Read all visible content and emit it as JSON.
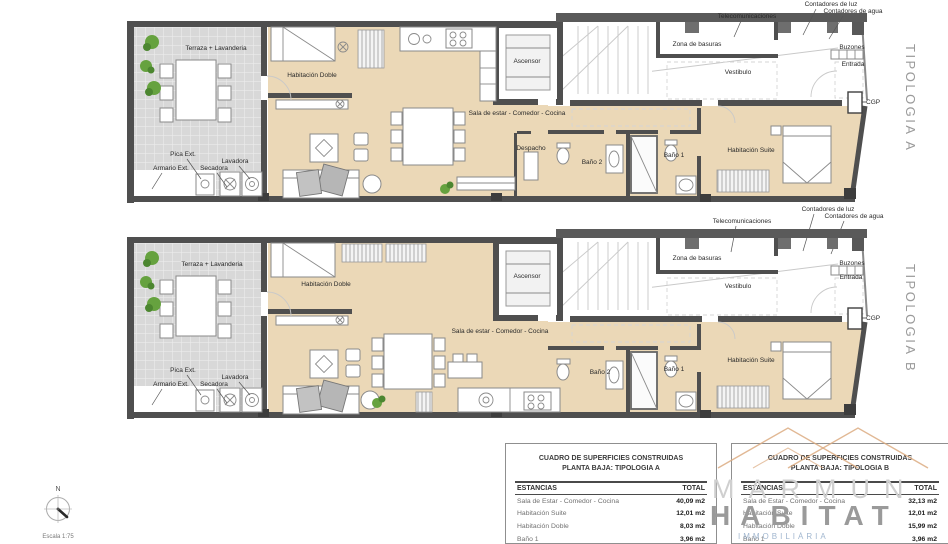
{
  "colors": {
    "wall": "#4f4f4f",
    "floor": "#ebd8b7",
    "terrace": "#d8d8d8",
    "plant_green": "#66a23f",
    "logo_orange": "#dcab81",
    "tipologia_gray": "#9a9a9a",
    "watermark_blue": "#8aa5c4"
  },
  "plan_a": {
    "tipologia": "TIPOLOGIA A",
    "terraza": "Terraza + Lavanderia",
    "hab_doble": "Habitación Doble",
    "sala": "Sala de estar - Comedor - Cocina",
    "despacho": "Despacho",
    "ascensor": "Ascensor",
    "zona_basuras": "Zona de basuras",
    "vestibulo": "Vestibulo",
    "bano2": "Baño 2",
    "bano1": "Baño 1",
    "suite": "Habitación Suite",
    "entrada": "Entrada",
    "buzones": "Buzones",
    "cgp": "CGP",
    "telecomunicaciones": "Telecomunicaciones",
    "contadores_luz": "Contadores de luz",
    "contadores_agua": "Contadores de agua",
    "pica": "Pica Ext.",
    "armario": "Armario Ext.",
    "secadora": "Secadora",
    "lavadora": "Lavadora"
  },
  "plan_b": {
    "tipologia": "TIPOLOGIA B",
    "terraza": "Terraza + Lavanderia",
    "hab_doble": "Habitación Doble",
    "sala": "Sala de estar - Comedor - Cocina",
    "ascensor": "Ascensor",
    "zona_basuras": "Zona de basuras",
    "vestibulo": "Vestibulo",
    "bano2": "Baño 2",
    "bano1": "Baño 1",
    "suite": "Habitación Suite",
    "entrada": "Entrada",
    "buzones": "Buzones",
    "cgp": "CGP",
    "telecomunicaciones": "Telecomunicaciones",
    "contadores_luz": "Contadores de luz",
    "contadores_agua": "Contadores de agua",
    "pica": "Pica Ext.",
    "armario": "Armario Ext.",
    "secadora": "Secadora",
    "lavadora": "Lavadora"
  },
  "tables": {
    "a": {
      "title1": "CUADRO DE SUPERFICIES CONSTRUIDAS",
      "title2": "PLANTA BAJA: TIPOLOGIA A",
      "col_estancias": "ESTANCIAS",
      "col_total": "TOTAL",
      "rows": [
        {
          "name": "Sala de Estar - Comedor - Cocina",
          "total": "40,09 m2"
        },
        {
          "name": "Habitación Suite",
          "total": "12,01 m2"
        },
        {
          "name": "Habitación Doble",
          "total": "8,03 m2"
        },
        {
          "name": "Baño 1",
          "total": "3,96 m2"
        }
      ]
    },
    "b": {
      "title1": "CUADRO DE SUPERFICIES CONSTRUIDAS",
      "title2": "PLANTA BAJA: TIPOLOGIA B",
      "col_estancias": "ESTANCIAS",
      "col_total": "TOTAL",
      "rows": [
        {
          "name": "Sala de Estar - Comedor - Cocina",
          "total": "32,13 m2"
        },
        {
          "name": "Habitación Suite",
          "total": "12,01 m2"
        },
        {
          "name": "Habitación Doble",
          "total": "15,99 m2"
        },
        {
          "name": "Baño 1",
          "total": "3,96 m2"
        }
      ]
    }
  },
  "compass": {
    "north": "N",
    "scale": "Escala 1:75"
  },
  "watermark": {
    "brand_top": "MARMUN",
    "brand_bottom": "HABITAT",
    "tagline": "IMMOBILIÀRIA"
  }
}
